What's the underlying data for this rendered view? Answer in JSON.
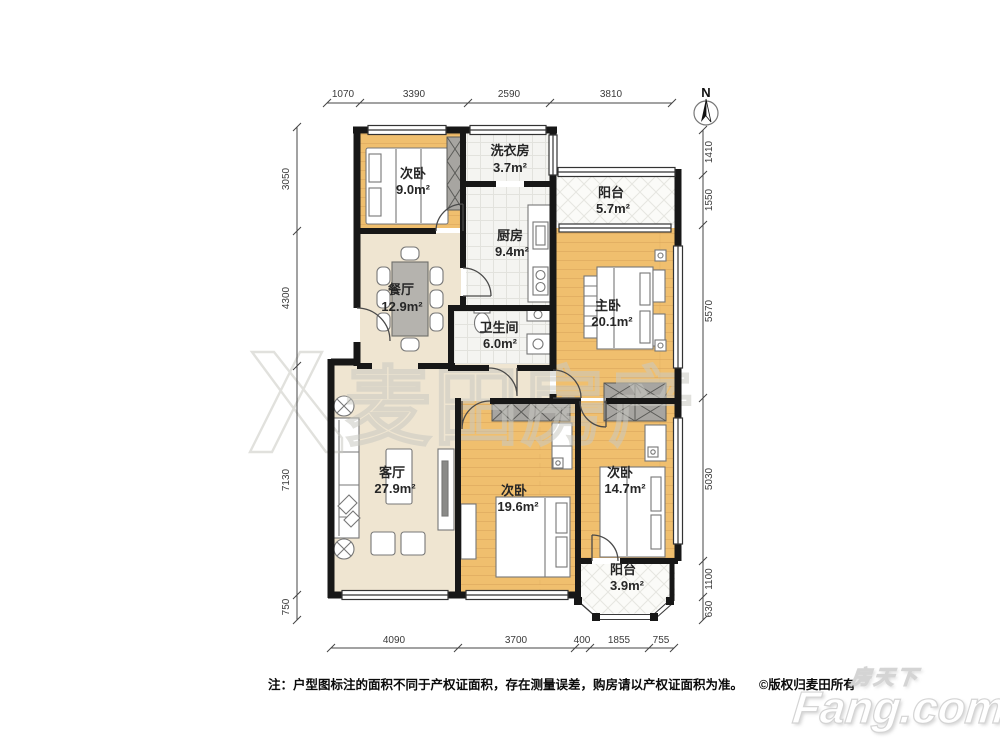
{
  "north_label": "N",
  "watermark": {
    "text": "麦田房产"
  },
  "rooms": [
    {
      "id": "bedroom-a",
      "name": "次卧",
      "area": "9.0m²"
    },
    {
      "id": "laundry",
      "name": "洗衣房",
      "area": "3.7m²"
    },
    {
      "id": "balcony-top",
      "name": "阳台",
      "area": "5.7m²"
    },
    {
      "id": "kitchen",
      "name": "厨房",
      "area": "9.4m²"
    },
    {
      "id": "dining",
      "name": "餐厅",
      "area": "12.9m²"
    },
    {
      "id": "master",
      "name": "主卧",
      "area": "20.1m²"
    },
    {
      "id": "bathroom",
      "name": "卫生间",
      "area": "6.0m²"
    },
    {
      "id": "living",
      "name": "客厅",
      "area": "27.9m²"
    },
    {
      "id": "bedroom-b",
      "name": "次卧",
      "area": "19.6m²"
    },
    {
      "id": "bedroom-c",
      "name": "次卧",
      "area": "14.7m²"
    },
    {
      "id": "balcony-bottom",
      "name": "阳台",
      "area": "3.9m²"
    }
  ],
  "dimensions": {
    "top": [
      "1070",
      "3390",
      "2590",
      "3810"
    ],
    "left": [
      "3050",
      "4300",
      "7130",
      "750"
    ],
    "right": [
      "1410",
      "1550",
      "5570",
      "5030",
      "1100",
      "630"
    ],
    "bottom": [
      "4090",
      "3700",
      "400",
      "1855",
      "755"
    ]
  },
  "footer": {
    "note": "注：户型图标注的面积不同于产权证面积，存在测量误差，购房请以产权证面积为准。",
    "copyright": "©版权归麦田所有"
  },
  "logo": {
    "cn": "房天下",
    "en": "Fang.com"
  },
  "colors": {
    "wall": "#171717",
    "wood_floor": "#f0bf6e",
    "beige_floor": "#efe5d1",
    "tile_floor": "#f4f4f1",
    "balcony_floor": "#fbfbf8",
    "wardrobe": "#a7a5a1",
    "watermark_stroke": "#c9c9c2"
  }
}
